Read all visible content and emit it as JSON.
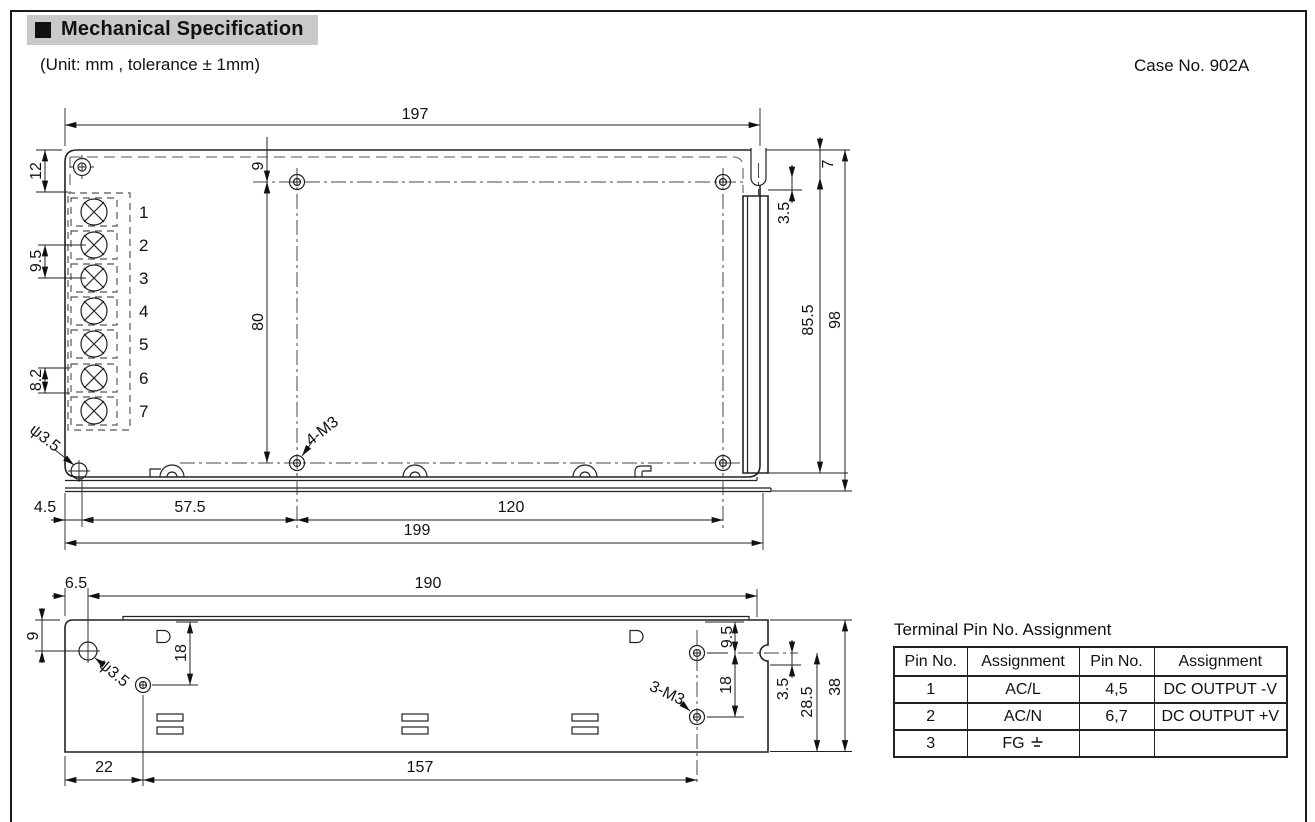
{
  "header": {
    "title": "Mechanical Specification",
    "subtitle": "(Unit: mm , tolerance ± 1mm)",
    "case_no": "Case No. 902A"
  },
  "top_view": {
    "dim_width": "197",
    "dim_corner_offset": "12",
    "dim_term_pitch": "9.5",
    "dim_term_pitch2": "8.2",
    "dim_hole_inset_top": "9",
    "dim_hole_span_v": "80",
    "dim_notch_depth": "7",
    "dim_notch_offset": "3.5",
    "dim_flange_height": "85.5",
    "dim_height": "98",
    "dim_edge_offset": "4.5",
    "dim_hole_inset_left": "57.5",
    "dim_hole_span_h": "120",
    "dim_width_overall": "199",
    "hole_label": "ψ3.5",
    "screw_label": "4-M3",
    "terminals": [
      "1",
      "2",
      "3",
      "4",
      "5",
      "6",
      "7"
    ]
  },
  "side_view": {
    "dim_edge_offset": "6.5",
    "dim_width": "190",
    "dim_hole_top": "9",
    "dim_hole_v": "18",
    "dim_hole_left": "22",
    "dim_hole_span": "157",
    "dim_right_top": "9.5",
    "dim_right_mid": "18",
    "dim_notch_offset": "3.5",
    "dim_right_low": "28.5",
    "dim_height": "38",
    "hole_label": "ψ3.5",
    "screw_label": "3-M3"
  },
  "pin_table": {
    "title": "Terminal Pin No.  Assignment",
    "headers": [
      "Pin No.",
      "Assignment",
      "Pin No.",
      "Assignment"
    ],
    "rows": [
      [
        "1",
        "AC/L",
        "4,5",
        "DC OUTPUT -V"
      ],
      [
        "2",
        "AC/N",
        "6,7",
        "DC OUTPUT +V"
      ],
      [
        "3",
        "FG",
        "",
        ""
      ]
    ]
  }
}
